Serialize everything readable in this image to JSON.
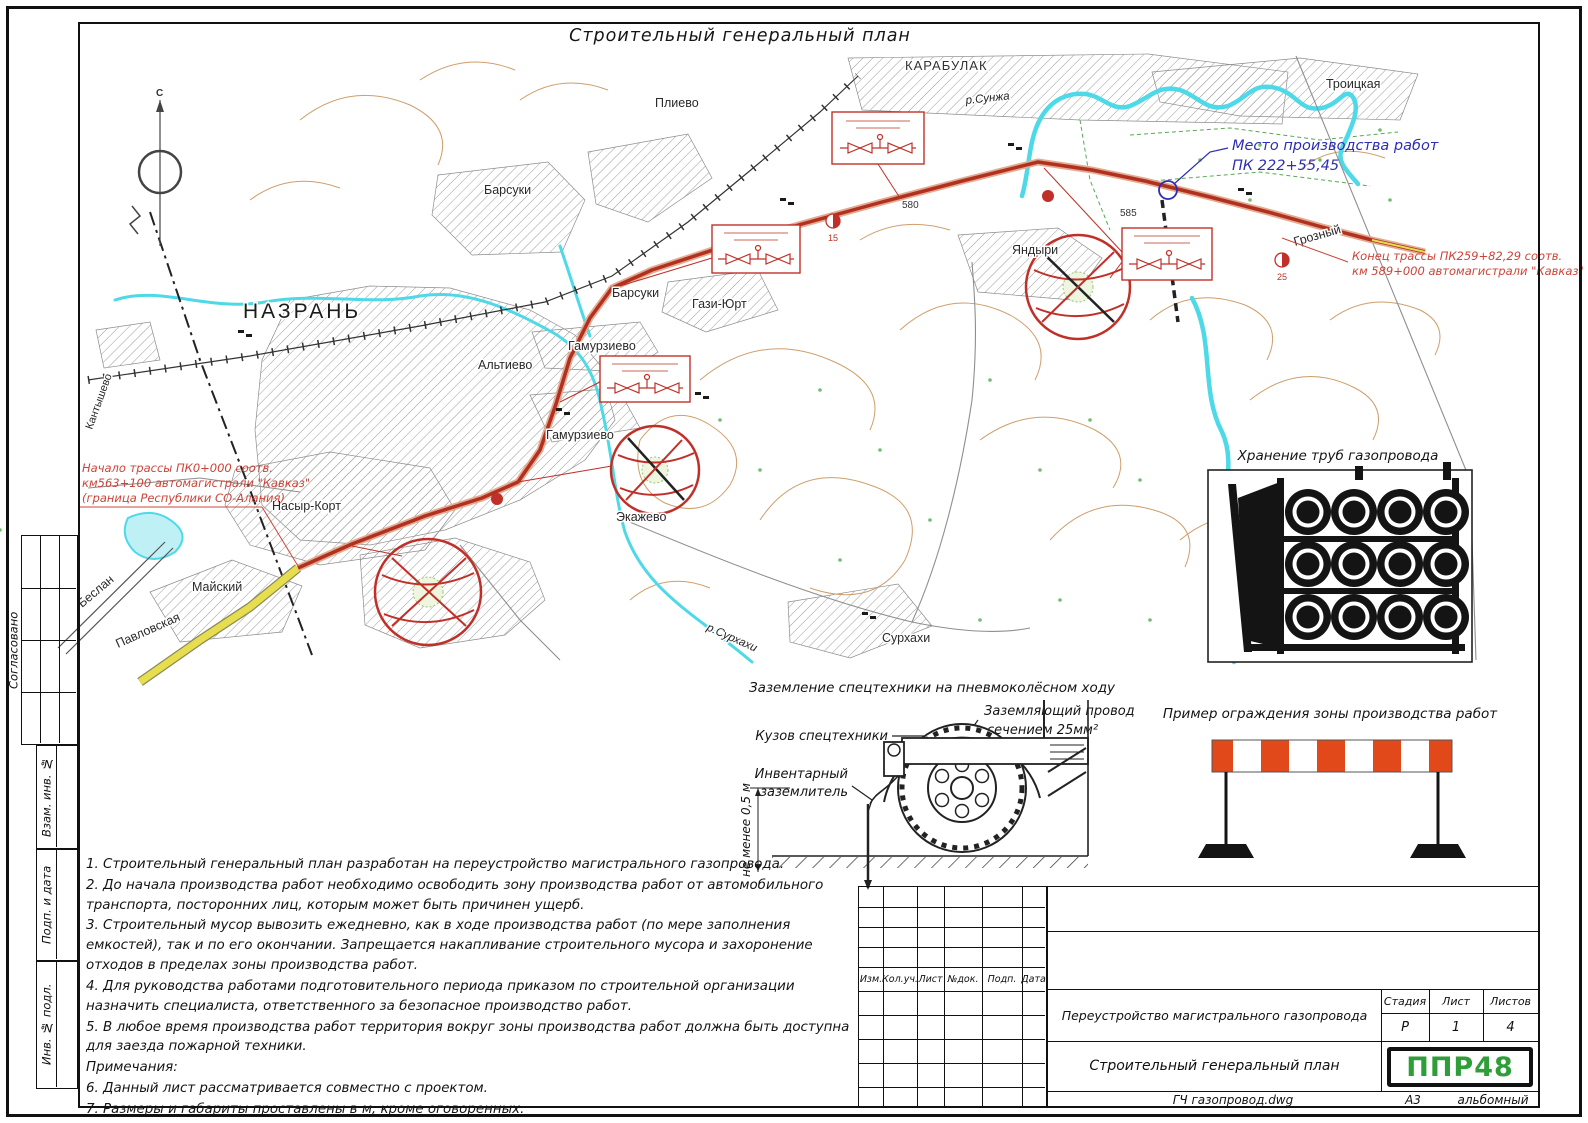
{
  "sheet": {
    "title": "Строительный генеральный план"
  },
  "sidebar": {
    "soglasovano": "Согласовано",
    "vzam_inv": "Взам. инв. №",
    "podp_data": "Подп. и дата",
    "inv_podl": "Инв. № подл."
  },
  "map": {
    "compass_north": "С",
    "places": {
      "nazran": "НАЗРАНЬ",
      "karabulak": "КАРАБУЛАК",
      "plievo": "Плиево",
      "barsuki_top": "Барсуки",
      "barsuki": "Барсуки",
      "gazi_yurt": "Гази-Юрт",
      "altievo": "Альтиево",
      "gamurzievo_1": "Гамурзиево",
      "gamurzievo_2": "Гамурзиево",
      "nasyr_kort": "Насыр-Корт",
      "ekazhevo": "Экажево",
      "maysky": "Майский",
      "surkhakhi": "Сурхахи",
      "yandyri": "Яндыри",
      "troitskaya": "Троицкая",
      "grozny": "Грозный",
      "kantyshevo": "Кантышево",
      "beslan": "Беслан",
      "pavlovskaya": "Павловская",
      "r_sunzha": "р.Сунжа",
      "r_surkhakhi": "р.Сурхахи"
    },
    "elevations": {
      "e580": "580",
      "e585": "585"
    },
    "markers": {
      "m15": "15",
      "m25": "25"
    },
    "worksite": {
      "line1": "Место производства работ",
      "line2": "ПК 222+55,45"
    },
    "route_start": {
      "l1": "Начало трассы ПК0+000 соотв.",
      "l2": "км563+100 автомагистрали \"Кавказ\"",
      "l3": "(граница Республики СО-Алания)"
    },
    "route_end": {
      "l1": "Конец трассы ПК259+82,29 соотв.",
      "l2": "км 589+000 автомагистрали \"Кавказ\""
    }
  },
  "details": {
    "pipes_title": "Хранение труб газопровода",
    "grounding": {
      "title": "Заземление спецтехники на пневмоколёсном ходу",
      "wire_l1": "Заземляющий провод",
      "wire_l2": "сечением 25мм²",
      "body": "Кузов спецтехники",
      "earthing_l1": "Инвентарный",
      "earthing_l2": "заземлитель",
      "min_dist": "не менее 0,5 м"
    },
    "fence_title": "Пример ограждения зоны производства работ"
  },
  "notes": {
    "main": [
      "1.  Строительный генеральный план разработан на переустройство магистрального газопровода.",
      "2.  До начала производства работ необходимо освободить зону производства работ от автомобильного транспорта, посторонних лиц, которым может быть причинен ущерб.",
      "3.  Строительный мусор вывозить ежедневно, как в ходе производства работ (по мере заполнения емкостей), так и по его окончании. Запрещается накапливание строительного мусора и захоронение отходов в пределах зоны производства работ.",
      "4.  Для руководства работами подготовительного периода приказом по строительной организации назначить специалиста, ответственного за безопасное производство работ.",
      "5.  В любое время производства работ территория вокруг зоны производства работ должна быть доступна для заезда пожарной техники."
    ],
    "subheader": "Примечания:",
    "extra": [
      "6.  Данный лист рассматривается совместно с проектом.",
      "7.  Размеры и габариты проставлены в м, кроме оговоренных.",
      "8.  Размеры и отметки со * уточнить по месту."
    ]
  },
  "titleblock": {
    "rev_cols": [
      "Изм.",
      "Кол.уч.",
      "Лист",
      "№док.",
      "Подп.",
      "Дата"
    ],
    "project_title": "Переустройство магистрального газопровода",
    "drawing_title": "Строительный генеральный план",
    "stage_label": "Стадия",
    "sheet_label": "Лист",
    "sheets_label": "Листов",
    "stage_value": "Р",
    "sheet_value": "1",
    "sheets_value": "4",
    "logo_text": "ППР48",
    "footer_file": "ГЧ газопровод.dwg",
    "footer_format": "А3",
    "footer_orientation": "альбомный"
  },
  "colors": {
    "pipeline_red": "#b2301f",
    "river_cyan": "#4ed9e8",
    "detail_red": "#c03028",
    "annotation_blue": "#2d2db5",
    "annotation_red": "#cc4438",
    "road_yellow": "#e6de4e",
    "fence_orange": "#e1491b",
    "logo_green": "#2f9e38"
  }
}
